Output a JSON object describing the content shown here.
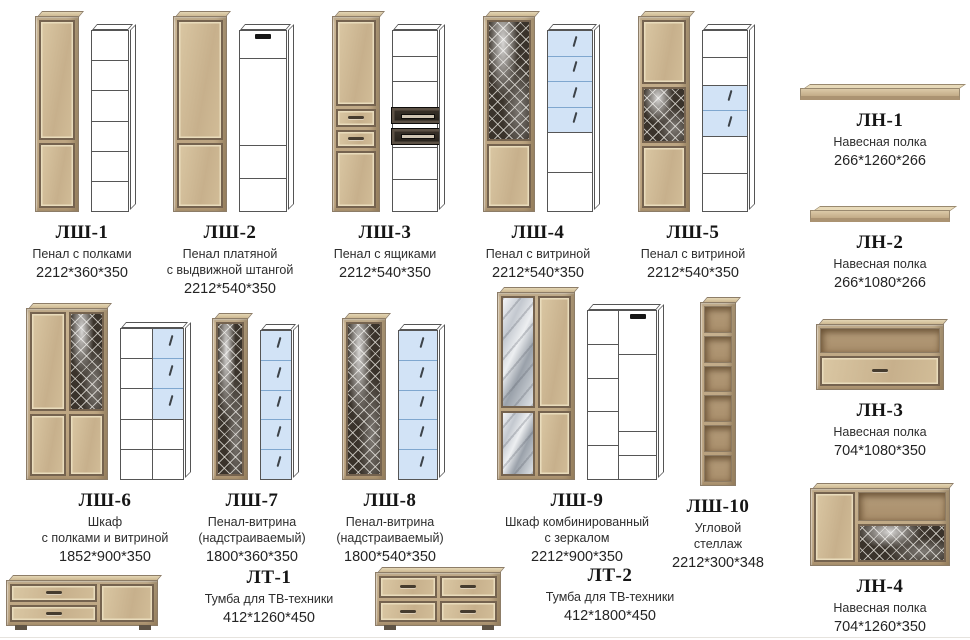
{
  "products": {
    "lsh1": {
      "code": "ЛШ-1",
      "name": "Пенал с полками",
      "dims": "2212*360*350"
    },
    "lsh2": {
      "code": "ЛШ-2",
      "name": "Пенал платяной\nс выдвижной штангой",
      "dims": "2212*540*350"
    },
    "lsh3": {
      "code": "ЛШ-3",
      "name": "Пенал с ящиками",
      "dims": "2212*540*350"
    },
    "lsh4": {
      "code": "ЛШ-4",
      "name": "Пенал с витриной",
      "dims": "2212*540*350"
    },
    "lsh5": {
      "code": "ЛШ-5",
      "name": "Пенал с витриной",
      "dims": "2212*540*350"
    },
    "lsh6": {
      "code": "ЛШ-6",
      "name": "Шкаф\nс полками и витриной",
      "dims": "1852*900*350"
    },
    "lsh7": {
      "code": "ЛШ-7",
      "name": "Пенал-витрина\n(надстраиваемый)",
      "dims": "1800*360*350"
    },
    "lsh8": {
      "code": "ЛШ-8",
      "name": "Пенал-витрина\n(надстраиваемый)",
      "dims": "1800*540*350"
    },
    "lsh9": {
      "code": "ЛШ-9",
      "name": "Шкаф комбинированный\nс зеркалом",
      "dims": "2212*900*350"
    },
    "lsh10": {
      "code": "ЛШ-10",
      "name": "Угловой\nстеллаж",
      "dims": "2212*300*348"
    },
    "ln1": {
      "code": "ЛН-1",
      "name": "Навесная полка",
      "dims": "266*1260*266"
    },
    "ln2": {
      "code": "ЛН-2",
      "name": "Навесная полка",
      "dims": "266*1080*266"
    },
    "ln3": {
      "code": "ЛН-3",
      "name": "Навесная полка",
      "dims": "704*1080*350"
    },
    "ln4": {
      "code": "ЛН-4",
      "name": "Навесная полка",
      "dims": "704*1260*350"
    },
    "lt1": {
      "code": "ЛТ-1",
      "name": "Тумба для ТВ-техники",
      "dims": "412*1260*450"
    },
    "lt2": {
      "code": "ЛТ-2",
      "name": "Тумба для ТВ-техники",
      "dims": "412*1800*450"
    }
  },
  "colors": {
    "wood": "#c9b492",
    "trim": "#75634f",
    "glass": "#bdd6f1",
    "lattice_dark": "#3a332b"
  }
}
